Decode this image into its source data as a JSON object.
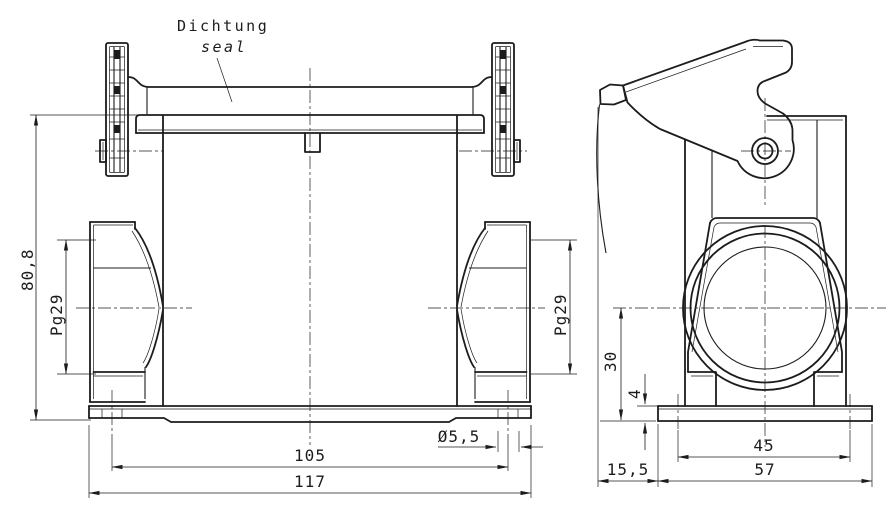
{
  "annotation": {
    "seal_label_de": "Dichtung",
    "seal_label_en": "seal"
  },
  "front_view": {
    "dimensions": {
      "overall_height": "80,8",
      "cable_entry_left": "Pg29",
      "cable_entry_right": "Pg29",
      "mounting_hole_spacing": "105",
      "overall_width": "117",
      "mounting_hole_diameter": "Ø5,5"
    }
  },
  "side_view": {
    "dimensions": {
      "entry_center_height": "30",
      "base_thickness": "4",
      "foot_hole_spacing": "45",
      "foot_width": "57",
      "lever_offset": "15,5"
    }
  },
  "colors": {
    "line": "#1c1c1c",
    "background": "#ffffff"
  }
}
